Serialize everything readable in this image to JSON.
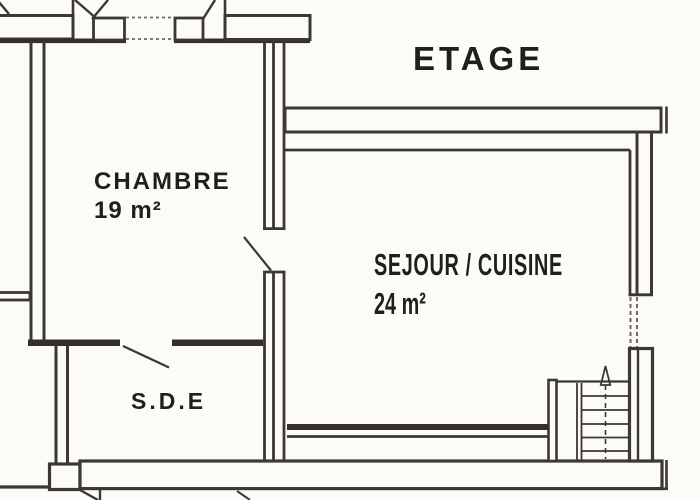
{
  "title": "ETAGE",
  "rooms": [
    {
      "name": "CHAMBRE",
      "area": "19 m²"
    },
    {
      "name": "SEJOUR / CUISINE",
      "area": "24 m²"
    },
    {
      "name": "S.D.E"
    }
  ],
  "icons": {
    "stairs_arrow": "up-arrow"
  },
  "colors": {
    "ink": "#3b3833",
    "ink_heavy": "#33302b",
    "ink_light": "#6f6a62",
    "paper": "#fcfbf8",
    "text": "#201f1d"
  }
}
